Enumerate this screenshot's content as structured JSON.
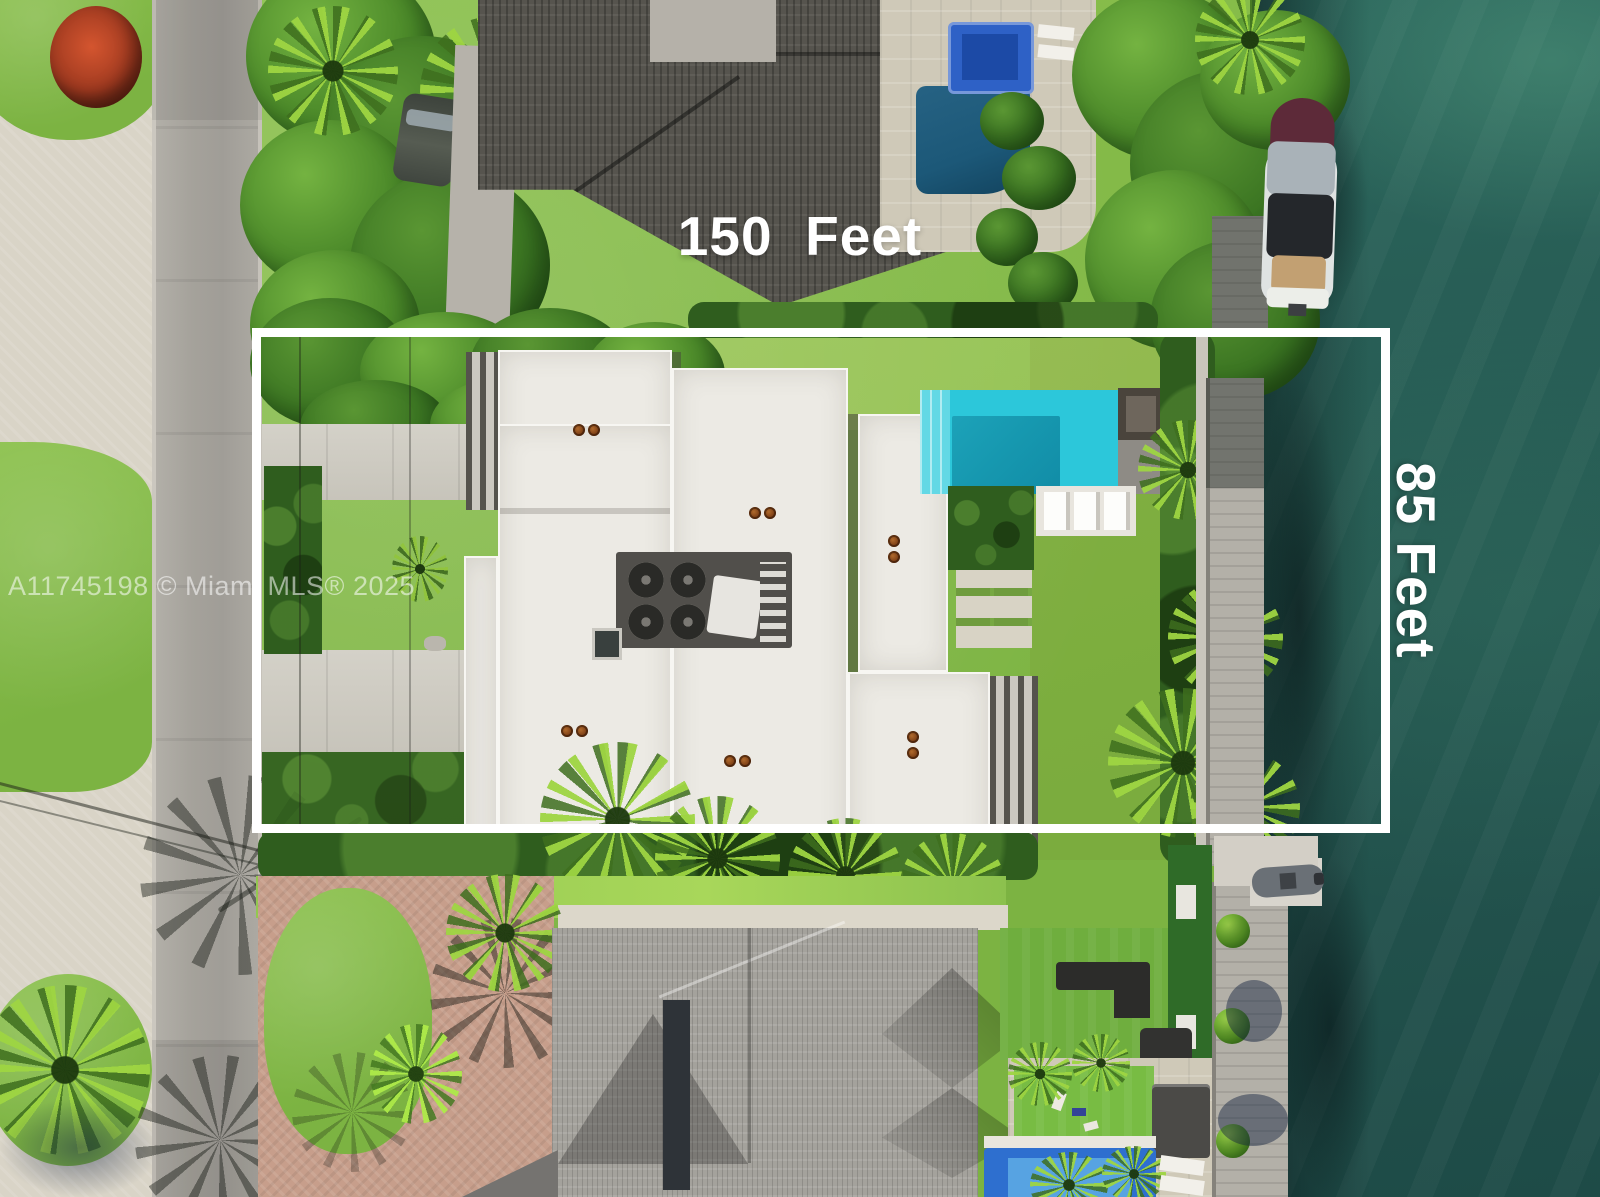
{
  "annotations": {
    "width_label": "150  Feet",
    "depth_label": "85 Feet",
    "watermark": "A11745198 © Miami MLS® 2025"
  },
  "palette": {
    "boundary_white": "#ffffff",
    "label_text": "#ffffff",
    "water_deep": "#1e4b47",
    "water_mid": "#255851",
    "water_light": "#2b665c",
    "pool_teal": "#2cc7da",
    "pool_deep": "#1493ab",
    "pool_steps": "#63d8e5",
    "neighbor_pool": "#1c5878",
    "spa_blue": "#2e61c6",
    "bottom_pool_rim": "#2e6fcf",
    "bottom_pool": "#57a3e2",
    "lawn": "#7cb342",
    "lawn_bright": "#8cc14e",
    "hedge": "#2f5d1e",
    "turf": "#6fae3e",
    "road": "#a6a39c",
    "concrete": "#cfccc2",
    "travertine": "#cfc9b8",
    "pavers_salmon": "#c79e8b",
    "pavers_pale": "#d9d4c7",
    "roof_dark": "#56544e",
    "roof_light": "#a4a29c",
    "roof_white": "#eceae4",
    "dock": "#b3b0a8",
    "boat_canopy": "#24272b",
    "boat_teak": "#c2a072",
    "ac_unit": "#514f4b"
  }
}
